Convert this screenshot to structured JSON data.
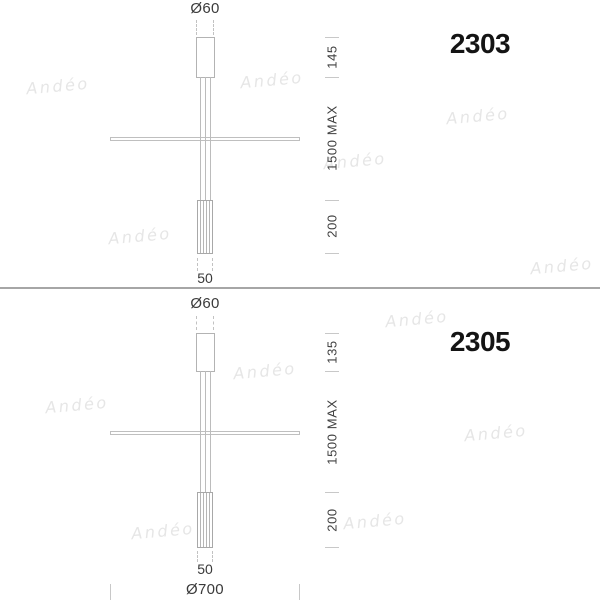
{
  "brand_watermark": {
    "text": "Andéo"
  },
  "colors": {
    "line": "#b3b3b3",
    "tick": "#c8c8c8",
    "dimension_text": "#3f3f3f",
    "model_text": "#141414",
    "separator": "#a6a6a6",
    "watermark": "#e6e6e6",
    "background": "#ffffff"
  },
  "lamps": [
    {
      "model": "2303",
      "canopy_diameter_label": "Ø60",
      "canopy_height_label": "145",
      "suspension_length_label": "1500 MAX",
      "tube_height_label": "200",
      "tube_width_label": "50"
    },
    {
      "model": "2305",
      "canopy_diameter_label": "Ø60",
      "canopy_height_label": "135",
      "suspension_length_label": "1500 MAX",
      "tube_height_label": "200",
      "tube_width_label": "50",
      "bar_diameter_label": "Ø700"
    }
  ],
  "watermarks": [
    {
      "x": 58,
      "y": 86
    },
    {
      "x": 272,
      "y": 80
    },
    {
      "x": 478,
      "y": 116
    },
    {
      "x": 355,
      "y": 161
    },
    {
      "x": 140,
      "y": 236
    },
    {
      "x": 562,
      "y": 266
    },
    {
      "x": 417,
      "y": 319
    },
    {
      "x": 265,
      "y": 371
    },
    {
      "x": 77,
      "y": 405
    },
    {
      "x": 496,
      "y": 433
    },
    {
      "x": 375,
      "y": 521
    },
    {
      "x": 163,
      "y": 531
    }
  ]
}
